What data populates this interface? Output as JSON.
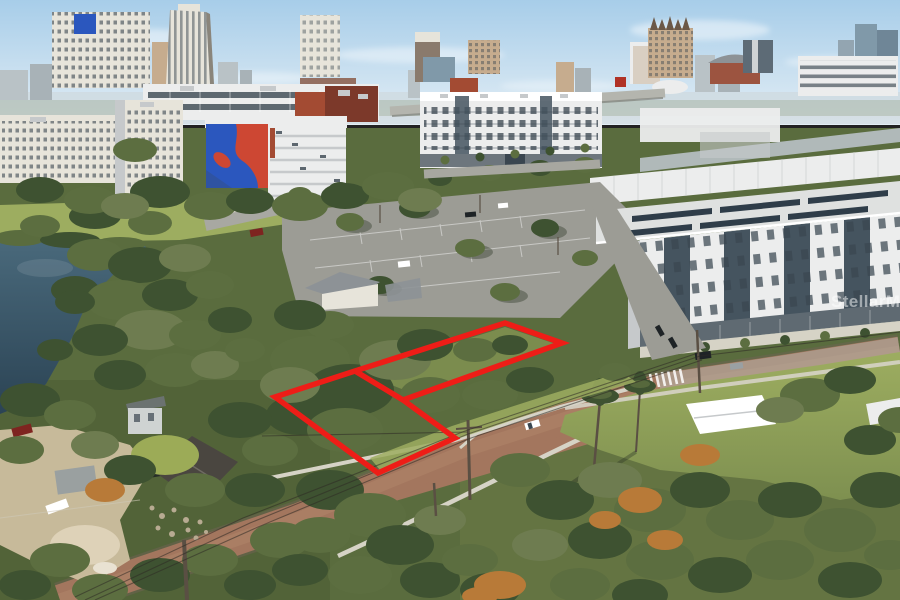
{
  "scene": {
    "type": "aerial-real-estate-photo",
    "description": "Aerial drone photo of a vacant land parcel outlined in red, surrounded by oak trees, a brick street, a lake at left, a large parking lot, modern white apartment buildings and a downtown city skyline under a light blue sky",
    "width": 900,
    "height": 600
  },
  "watermark": {
    "text": "StellarMLS"
  },
  "property_outline": {
    "color": "#ee1d17",
    "stroke_width": 5.5,
    "outer_points": "275,397 355,371 505,323 562,343 403,400 455,438 378,473",
    "divider_points": "355,371 403,400"
  },
  "powerlines": {
    "line1": "85,600 250,523 468,434 700,356",
    "line2": "95,600 258,527 471,438 702,360",
    "line3": "75,597 243,518 465,431 698,353",
    "branch": "262,436 468,432",
    "right": "700,356 900,332"
  },
  "palette": {
    "sky_top": "#a7cde9",
    "sky_bottom": "#e3eef5",
    "haze": "#ccd6d8",
    "distant1": "#b9c2c6",
    "distant2": "#a8b2b7",
    "building_white": "#eceded",
    "building_cream": "#e7e4da",
    "building_shadow": "#c6c9cb",
    "slate_panel": "#45545f",
    "window_dark": "#3a4650",
    "brick_red": "#7c392a",
    "brick_red_light": "#a34b33",
    "mural_blue": "#2b57be",
    "mural_red": "#cd4733",
    "tan_building": "#c6ac8e",
    "glass_blue": "#8099a9",
    "terracotta": "#9c5440",
    "roof_gray": "#8d9296",
    "asphalt": "#9c9c95",
    "asphalt_light": "#b3b2aa",
    "brick_street": "#a3765e",
    "street_edge": "#6f6253",
    "street_sheen": "#b8906f",
    "sidewalk": "#d6d3c6",
    "sand": "#cdbf9f",
    "sand_light": "#ded2b8",
    "water_top": "#4a6a7c",
    "water_bottom": "#2b4354",
    "grass_sun": "#9dad60",
    "grass_mid": "#7e9050",
    "grass_dark": "#5a6c3e",
    "canopy_dark": "#3e5231",
    "canopy_mid": "#5c6e40",
    "canopy_light": "#82924f",
    "canopy_olive": "#6e7c50",
    "canopy_rust": "#b87a38",
    "canopy_lime": "#9cab57",
    "outline_red": "#ee1d17",
    "wire": "#2e2a25",
    "pole": "#5a4f43",
    "white": "#ffffff",
    "solar_dark": "#2f3d49",
    "black_car": "#1e2326",
    "red_car": "#7e2420",
    "teal_tarp": "#2e7d86",
    "cone_orange": "#e07020"
  }
}
